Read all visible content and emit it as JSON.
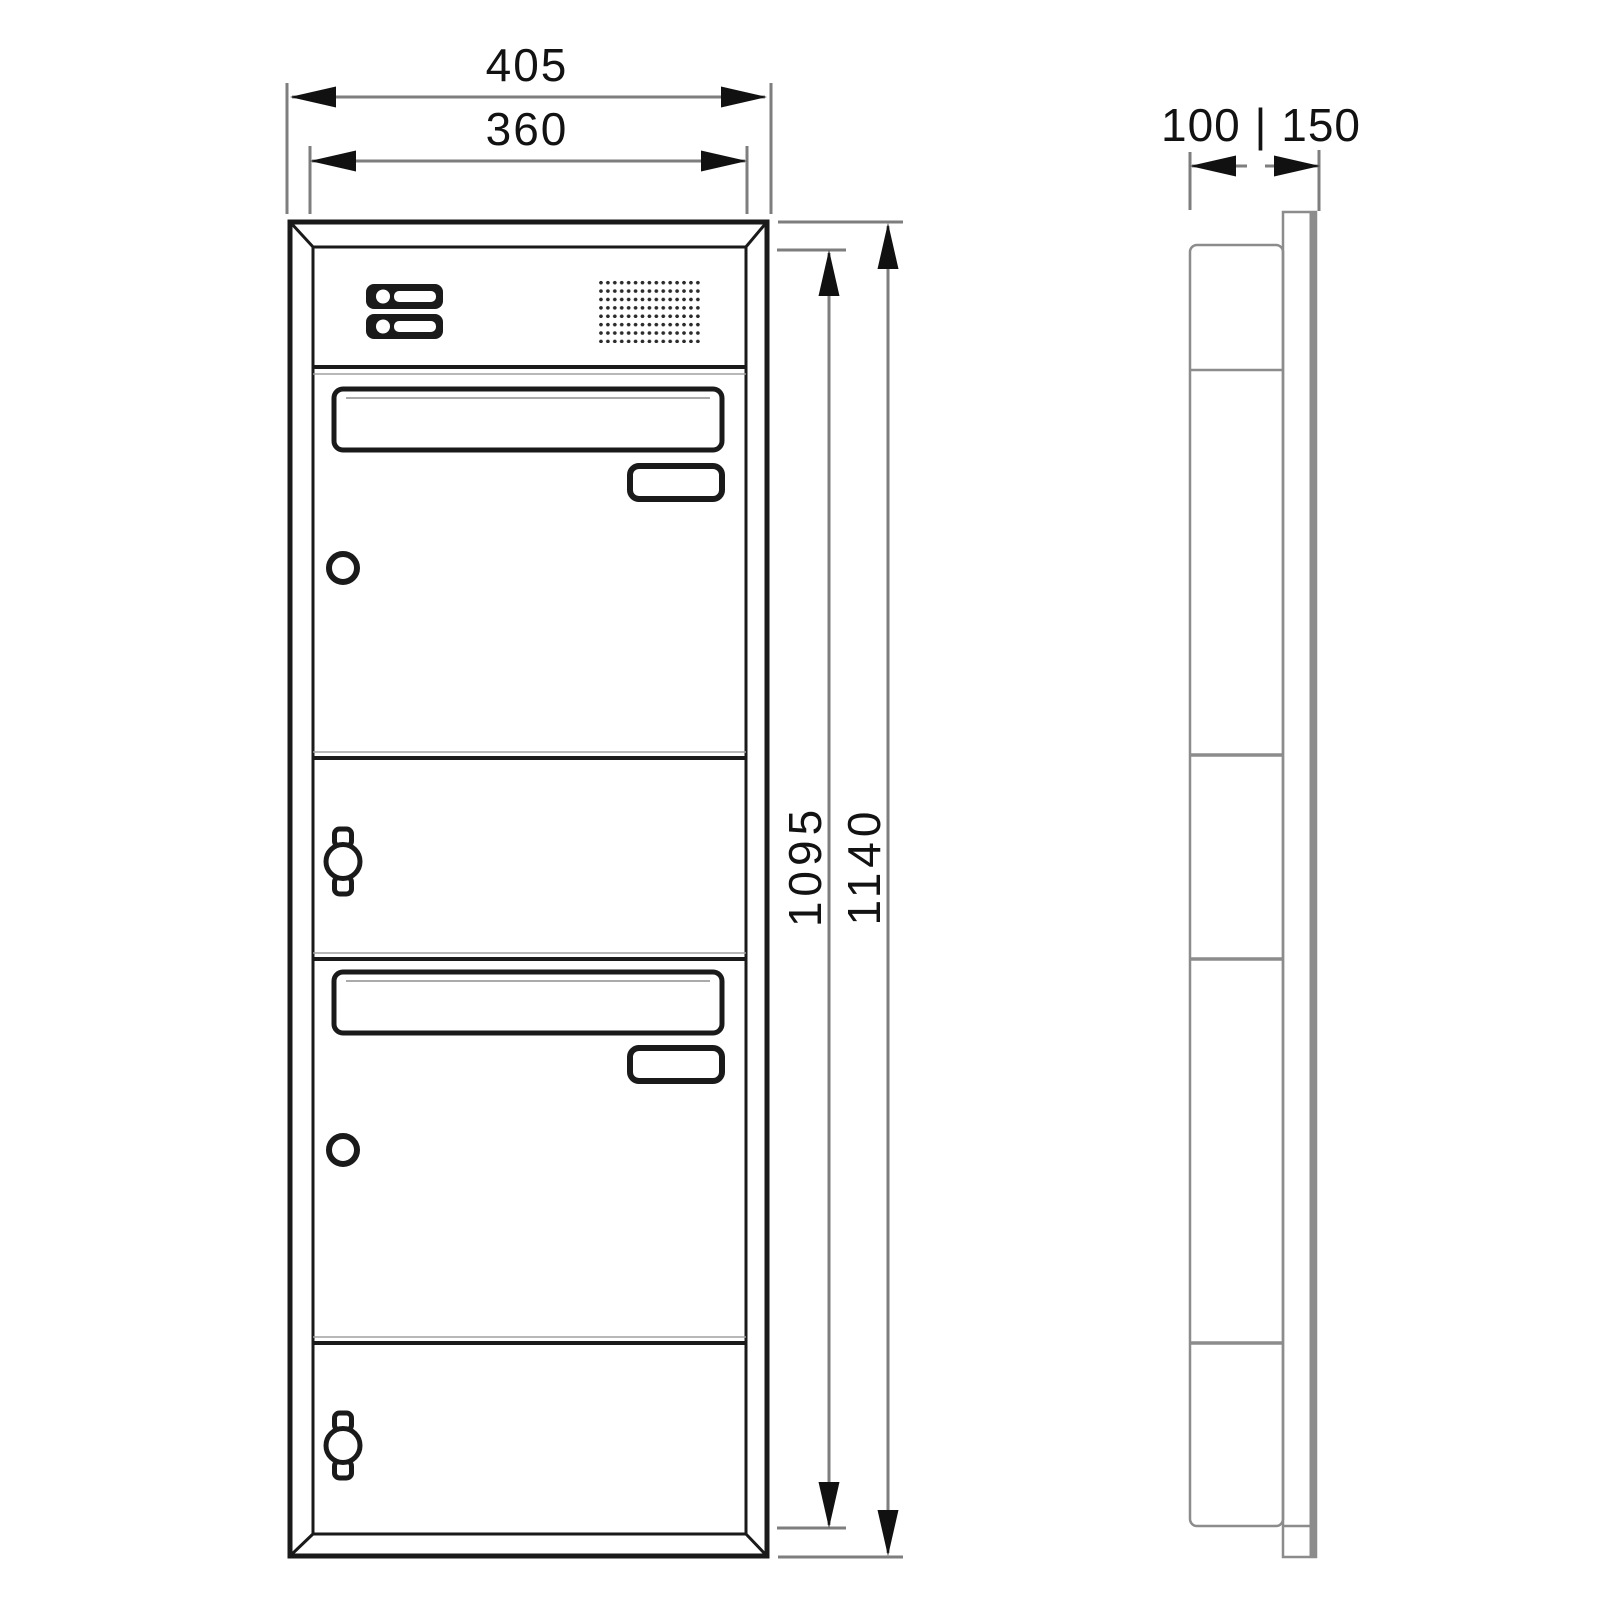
{
  "drawing": {
    "type": "technical-dimension-drawing",
    "views": {
      "front": "letterbox front view with intercom panel, 2 mailbox doors, 2 blank panels",
      "side": "side profile of in-wall box with front frame plate"
    },
    "dimensions": {
      "outer_width": "405",
      "inner_width": "360",
      "inner_height": "1095",
      "outer_height": "1140",
      "depth": "100 | 150"
    },
    "components": {
      "bell_buttons": 2,
      "speaker_grille": "dot-grid",
      "name_plates": 2,
      "mail_slot_handles": 2,
      "door_locks": 2,
      "panel_cylinder_locks": 2
    },
    "colors": {
      "background": "#ffffff",
      "drawing_line": "#1a1a1a",
      "dimension_line": "#7e7e7e",
      "side_view_line": "#8c8c8c",
      "dimension_text": "#121212"
    }
  }
}
